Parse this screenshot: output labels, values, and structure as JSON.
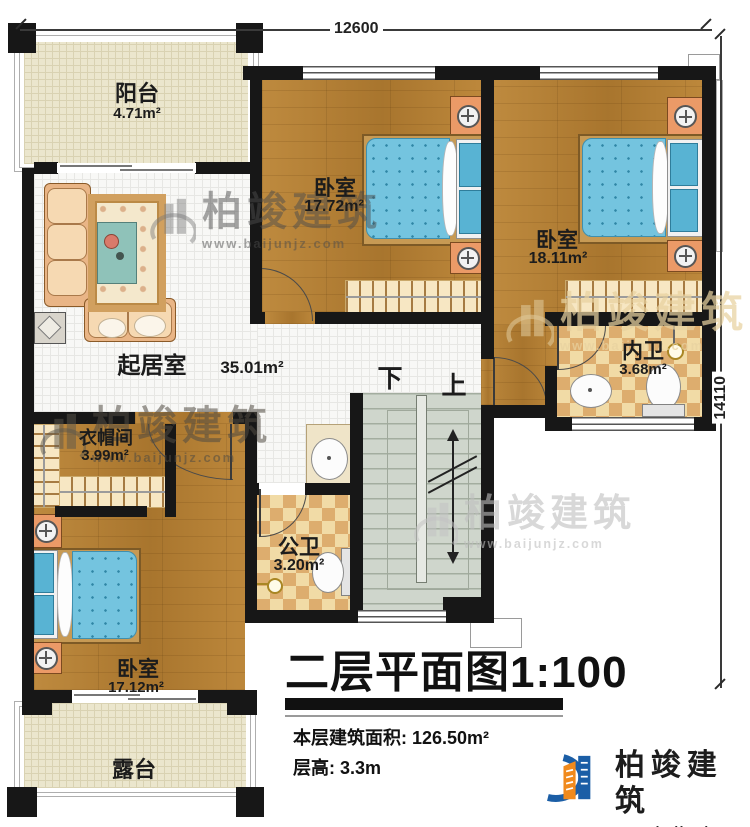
{
  "dimensions": {
    "top": "12600",
    "right": "14110"
  },
  "rooms": {
    "balcony": {
      "name": "阳台",
      "area": "4.71m²"
    },
    "bedroom1": {
      "name": "卧室",
      "area": "17.72m²"
    },
    "bedroom2": {
      "name": "卧室",
      "area": "18.11m²"
    },
    "living": {
      "name": "起居室",
      "area": "35.01m²"
    },
    "cloakroom": {
      "name": "衣帽间",
      "area": "3.99m²"
    },
    "public_bath": {
      "name": "公卫",
      "area": "3.20m²"
    },
    "inner_bath": {
      "name": "内卫",
      "area": "3.68m²"
    },
    "bedroom3": {
      "name": "卧室",
      "area": "17.12m²"
    },
    "terrace": {
      "name": "露台"
    }
  },
  "stairs": {
    "down": "下",
    "up": "上"
  },
  "title_block": {
    "title": "二层平面图1:100",
    "area_line": "本层建筑面积: 126.50m²",
    "floor_height_line": "层高: 3.3m"
  },
  "watermark": {
    "brand": "柏竣建筑",
    "site": "www.baijunjz.com"
  },
  "logo": {
    "brand": "柏竣建筑",
    "site": "www.baijunjz.com"
  },
  "colors": {
    "wall": "#171717",
    "wood": "#b57e31",
    "tile": "#f8f8f6",
    "cream": "#ebe6cd",
    "checker_light": "#f1dba6",
    "checker_dark": "#ddad6e",
    "stair": "#cfd6cc",
    "mattress": "#74c4df",
    "nightstand": "#eb9a67",
    "logo_blue": "#1b5ea6",
    "logo_orange": "#f08a1d"
  }
}
